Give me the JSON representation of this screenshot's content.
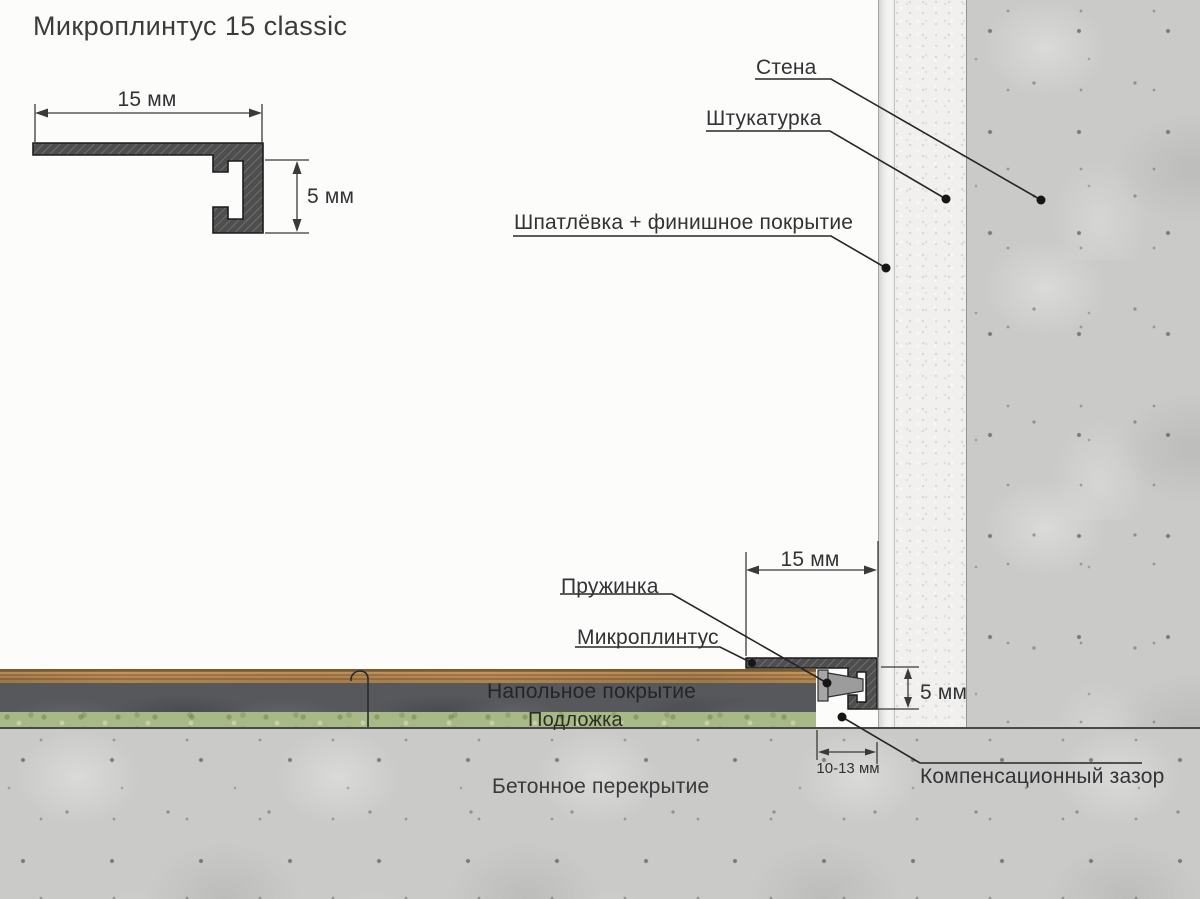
{
  "title": "Микроплинтус 15 classic",
  "profile_view": {
    "width_dim": "15 мм",
    "height_dim": "5 мм"
  },
  "wall_section": {
    "wall_label": "Стена",
    "plaster_label": "Штукатурка",
    "putty_label": "Шпатлёвка + финишное покрытие"
  },
  "floor_section": {
    "covering_label": "Напольное покрытие",
    "underlay_label": "Подложка",
    "slab_label": "Бетонное перекрытие"
  },
  "install_detail": {
    "spring_label": "Пружинка",
    "skirting_label": "Микроплинтус",
    "gap_callout_label": "Компенсационный зазор",
    "width_dim": "15 мм",
    "height_dim": "5 мм",
    "gap_dim": "10-13 мм"
  },
  "colors": {
    "profile_fill": "#4e4e4e",
    "wood": "#b1834e",
    "floor_core": "#56585b",
    "underlay": "#a9b887",
    "concrete": "#cacac8",
    "plaster": "#f1f0ee",
    "finish": "#ededeb",
    "line": "#2b2b2b"
  }
}
